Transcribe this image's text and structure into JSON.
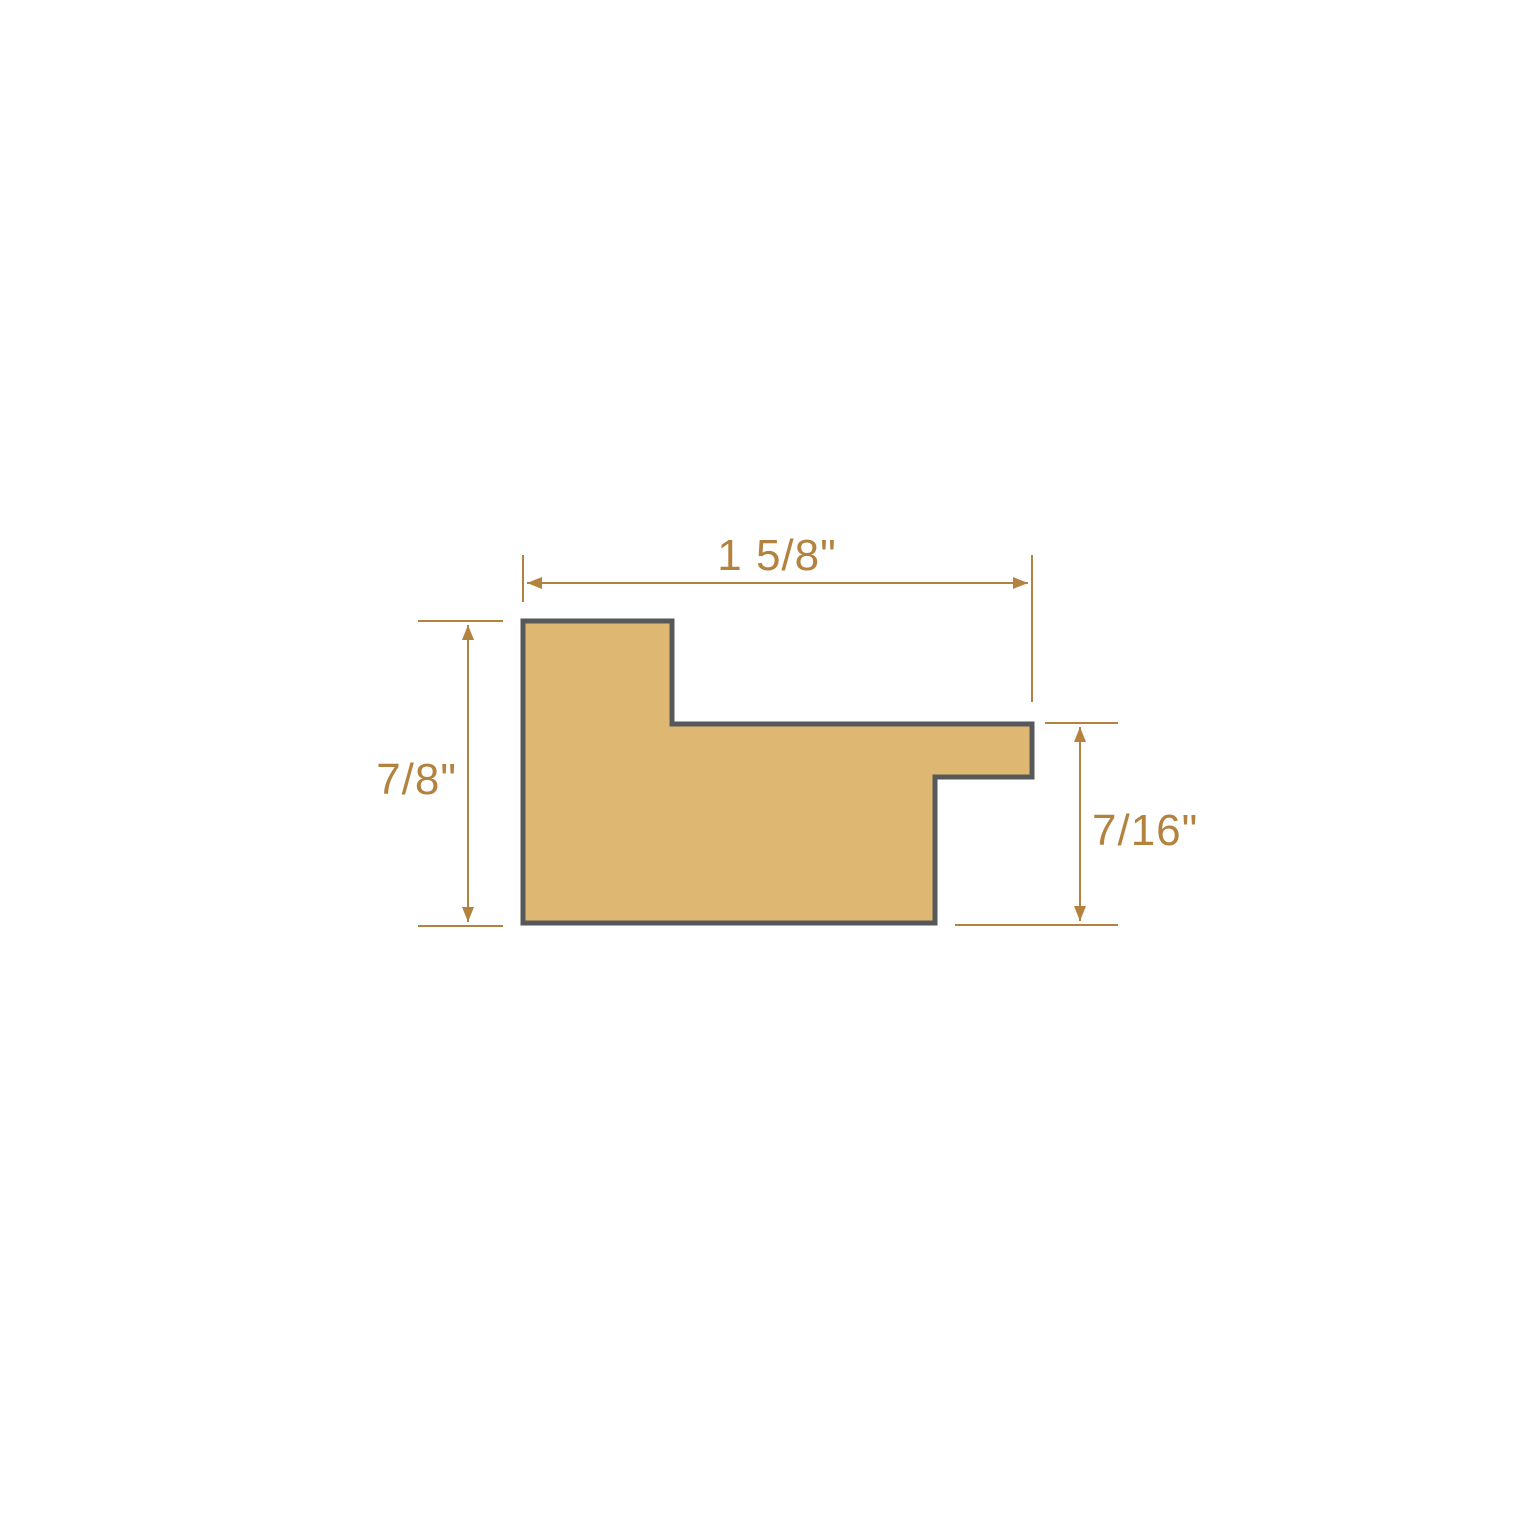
{
  "diagram": {
    "background": "#FFFFFF",
    "colors": {
      "profile_fill": "#DEB873",
      "profile_outline": "#56585A",
      "dimension_color": "#B3823E"
    },
    "profile": {
      "points": "523,621 672,621 672,724 1032,724 1032,777 935,777 935,923 523,923"
    },
    "dimensions": {
      "overall_width": {
        "label": "1 5/8\"",
        "orientation": "horizontal",
        "position": "top"
      },
      "overall_height": {
        "label": "7/8\"",
        "orientation": "vertical",
        "position": "left"
      },
      "rabbet_height": {
        "label": "7/16\"",
        "orientation": "vertical",
        "position": "right"
      }
    }
  }
}
